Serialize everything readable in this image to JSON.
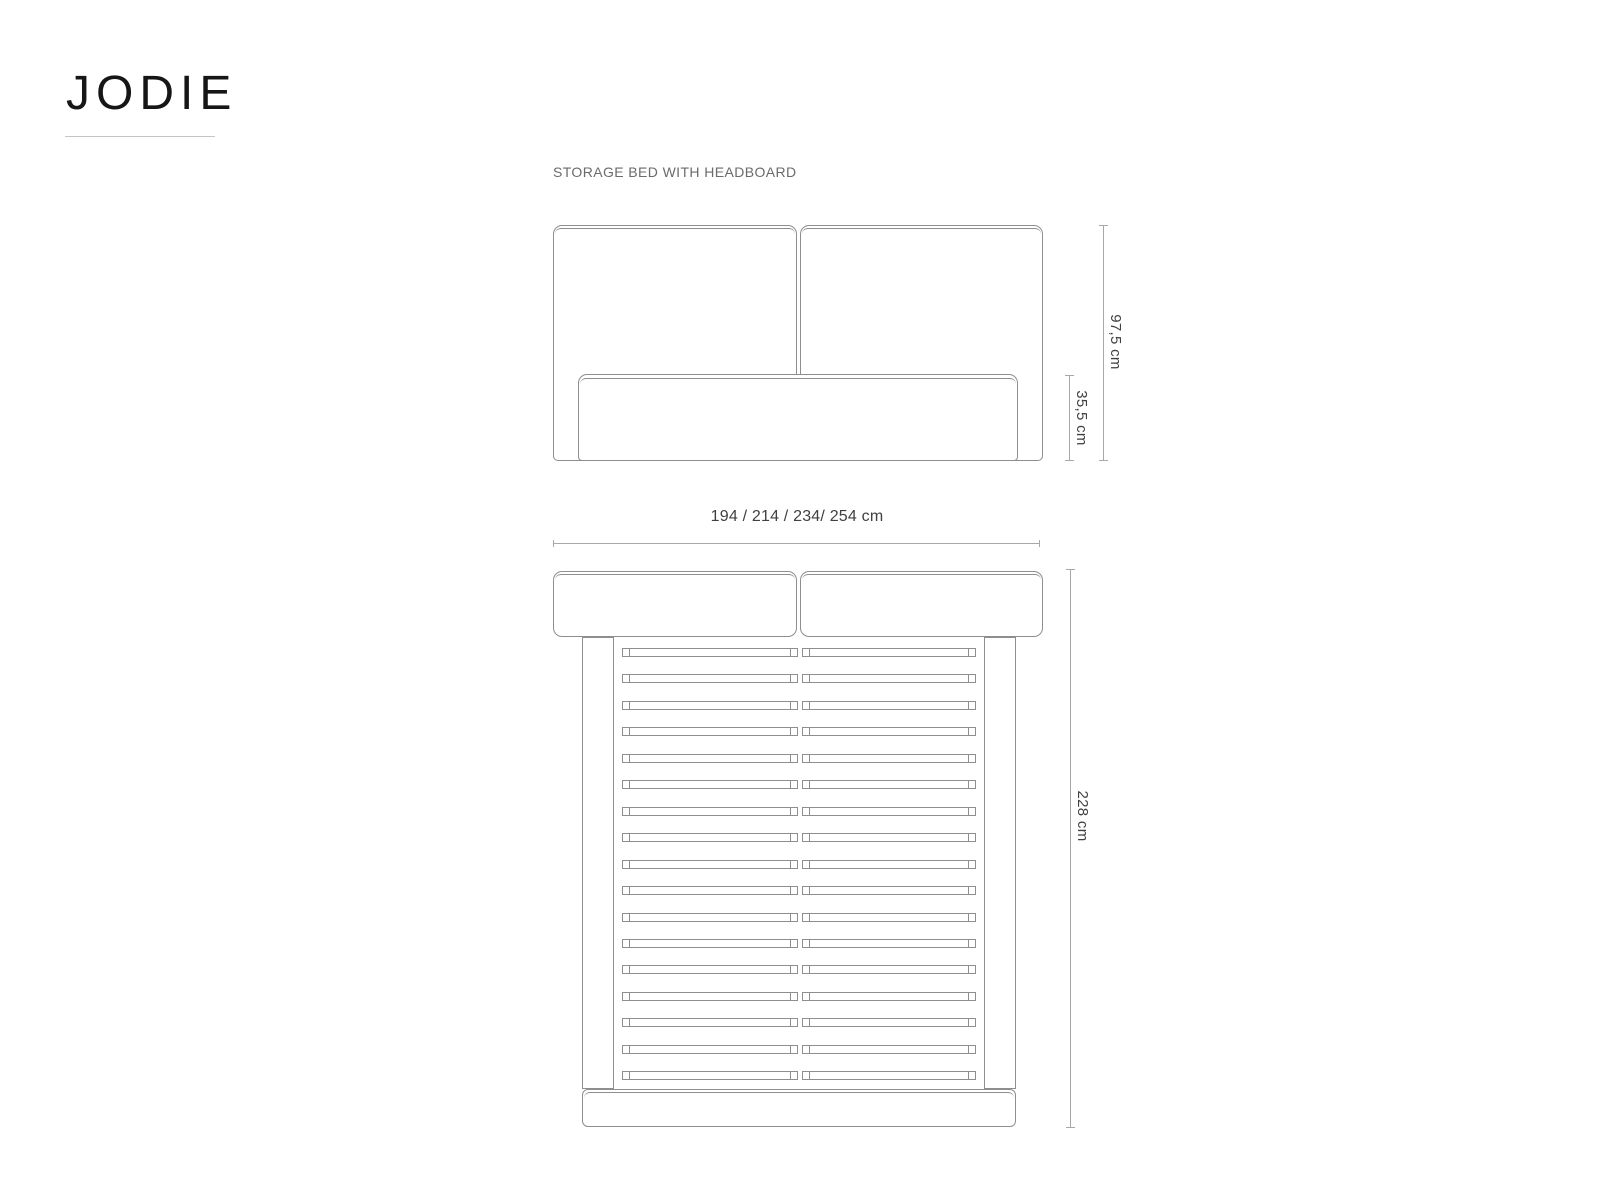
{
  "title": "JODIE",
  "subtitle": "STORAGE BED WITH HEADBOARD",
  "dimensions": {
    "headboard_height": "97,5 cm",
    "storage_height": "35,5 cm",
    "width_options": "194 / 214 / 234/ 254 cm",
    "length": "228 cm"
  },
  "top_view": {
    "slat_count": 17,
    "slat_first_top_px": 648,
    "slat_spacing_px": 26.45
  },
  "colors": {
    "background": "#ffffff",
    "title_text": "#161616",
    "subtitle_text": "#6b6b6b",
    "dimension_text": "#404040",
    "drawing_line": "#8e8e8e",
    "dimension_line": "#a8a8a8",
    "title_underline": "#c4c4c4"
  }
}
